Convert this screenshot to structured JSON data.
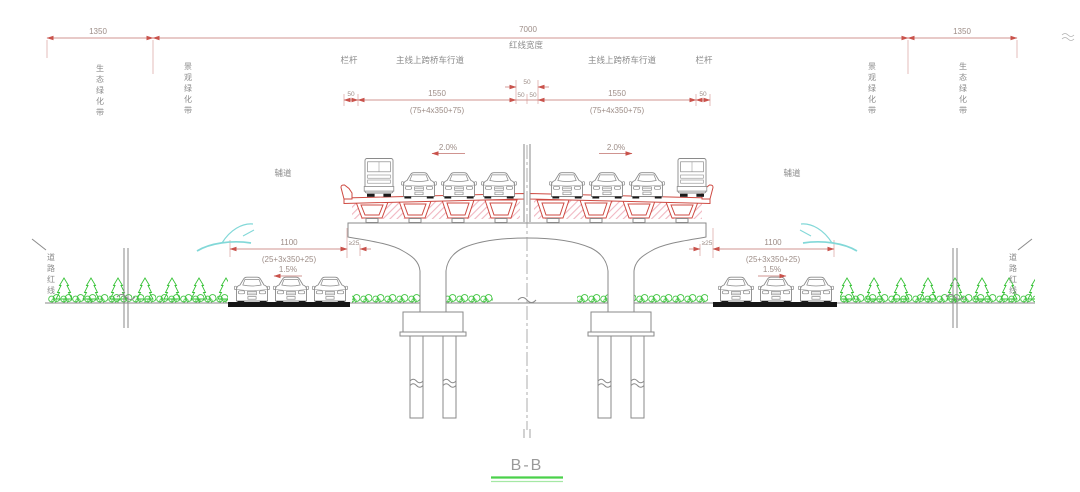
{
  "drawing": {
    "section_title": "B-B"
  },
  "top_dims": {
    "green_left": "1350",
    "red_line_width": "7000",
    "red_line_width_label": "红线宽度",
    "green_right": "1350"
  },
  "labels": {
    "eco_belt_left": "生态绿化带",
    "landscape_belt_left": "景观绿化带",
    "railing_left": "栏杆",
    "carriageway_left": "主线上跨桥车行道",
    "carriageway_right": "主线上跨桥车行道",
    "railing_right": "栏杆",
    "landscape_belt_right": "景观绿化带",
    "eco_belt_right": "生态绿化带",
    "service_road_left": "辅道",
    "service_road_right": "辅道",
    "road_red_line_left": "道路红线",
    "road_red_line_right": "道路红线"
  },
  "deck_dims": {
    "rail_left": "50",
    "lane_left": "1550",
    "median_left": "50",
    "median_total": "50",
    "median_right": "50",
    "lane_right": "1550",
    "rail_right": "50",
    "lane_left_detail": "(75+4x350+75)",
    "lane_right_detail": "(75+4x350+75)",
    "crossfall_left": "2.0%",
    "crossfall_right": "2.0%"
  },
  "ground_dims": {
    "service_left": "1100",
    "service_left_detail": "(25+3x350+25)",
    "gap_left": "≥25",
    "gap_right": "≥25",
    "service_right": "1100",
    "service_right_detail": "(25+3x350+25)",
    "crossfall_left": "1.5%",
    "crossfall_right": "1.5%"
  },
  "colors": {
    "dimension": "#c9524b",
    "drawing_line": "#8a8a8a",
    "bridge_red": "#ce4a42",
    "hatch_pink": "#f0b6c1",
    "vegetation_green": "#3ec43e",
    "water_cyan": "#82d8d8",
    "title_underline": "#4ad14a"
  }
}
